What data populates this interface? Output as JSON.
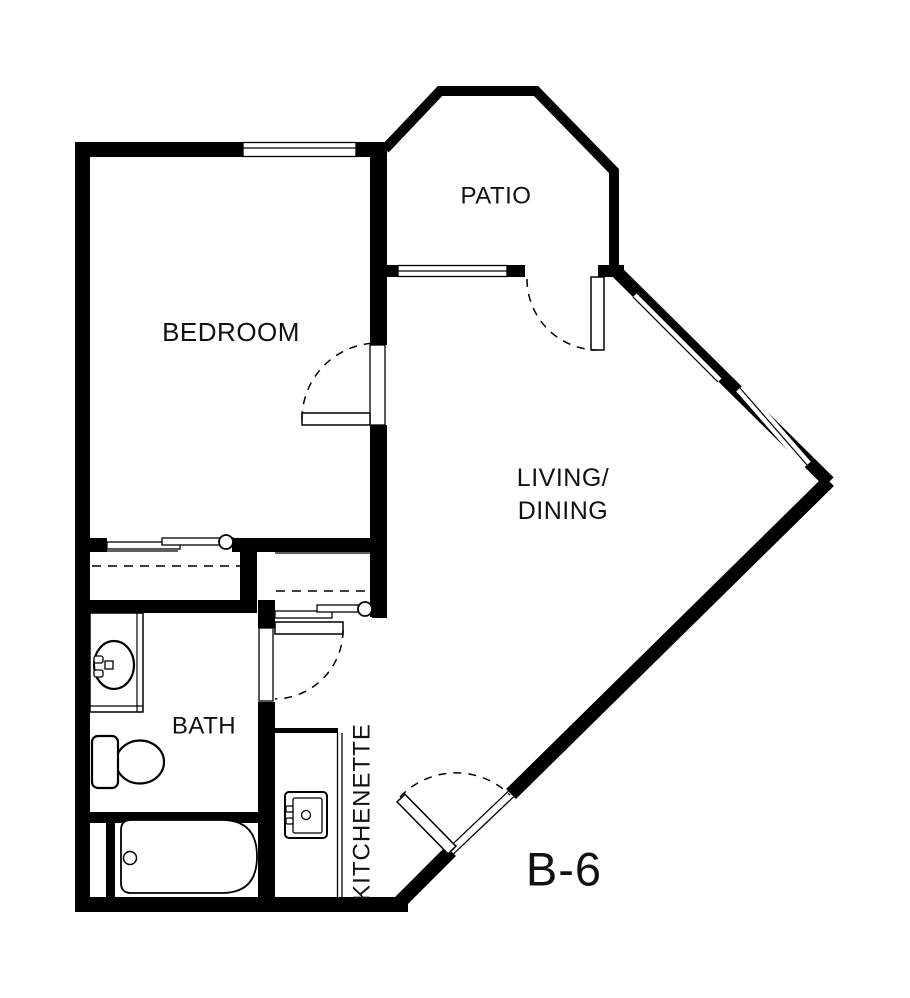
{
  "drawing": {
    "type": "apartment floor plan",
    "unit_label": "B-6",
    "rooms": {
      "bedroom": {
        "label": "BEDROOM"
      },
      "patio": {
        "label": "PATIO"
      },
      "living_dining": {
        "label_line1": "LIVING/",
        "label_line2": "DINING"
      },
      "bath": {
        "label": "BATH"
      },
      "kitchenette": {
        "label": "KITCHENETTE"
      }
    },
    "fixtures": [
      "bathtub",
      "toilet",
      "vanity-sink",
      "vanity-counter",
      "kitchenette-sink",
      "kitchenette-counter",
      "closet-bypass-doors",
      "closet-rod-dashed"
    ],
    "colors": {
      "walls": "#000000",
      "background": "#ffffff",
      "text": "#111111"
    }
  }
}
